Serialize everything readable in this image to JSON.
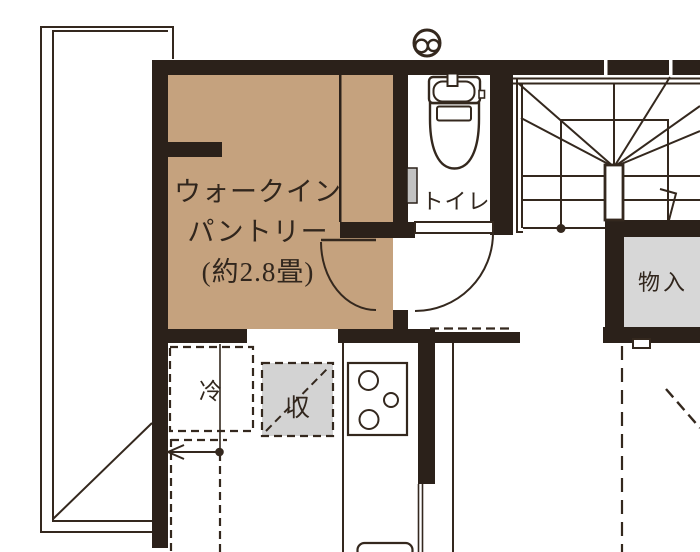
{
  "floorplan": {
    "pantry": {
      "line1": "ウォークイン",
      "line2": "パントリー",
      "line3": "(約2.8畳)",
      "fill": "#c5a27e"
    },
    "toilet": {
      "label": "トイレ"
    },
    "closet": {
      "label": "物入",
      "fill": "#d7d7d7"
    },
    "refrigerator": {
      "label": "冷"
    },
    "kitchen_storage": {
      "label": "収",
      "fill": "#d3d3d3"
    },
    "colors": {
      "wall": "#2b211a",
      "line": "#34281e",
      "text": "#31261d",
      "door_panel": "#c2c2c2"
    }
  }
}
